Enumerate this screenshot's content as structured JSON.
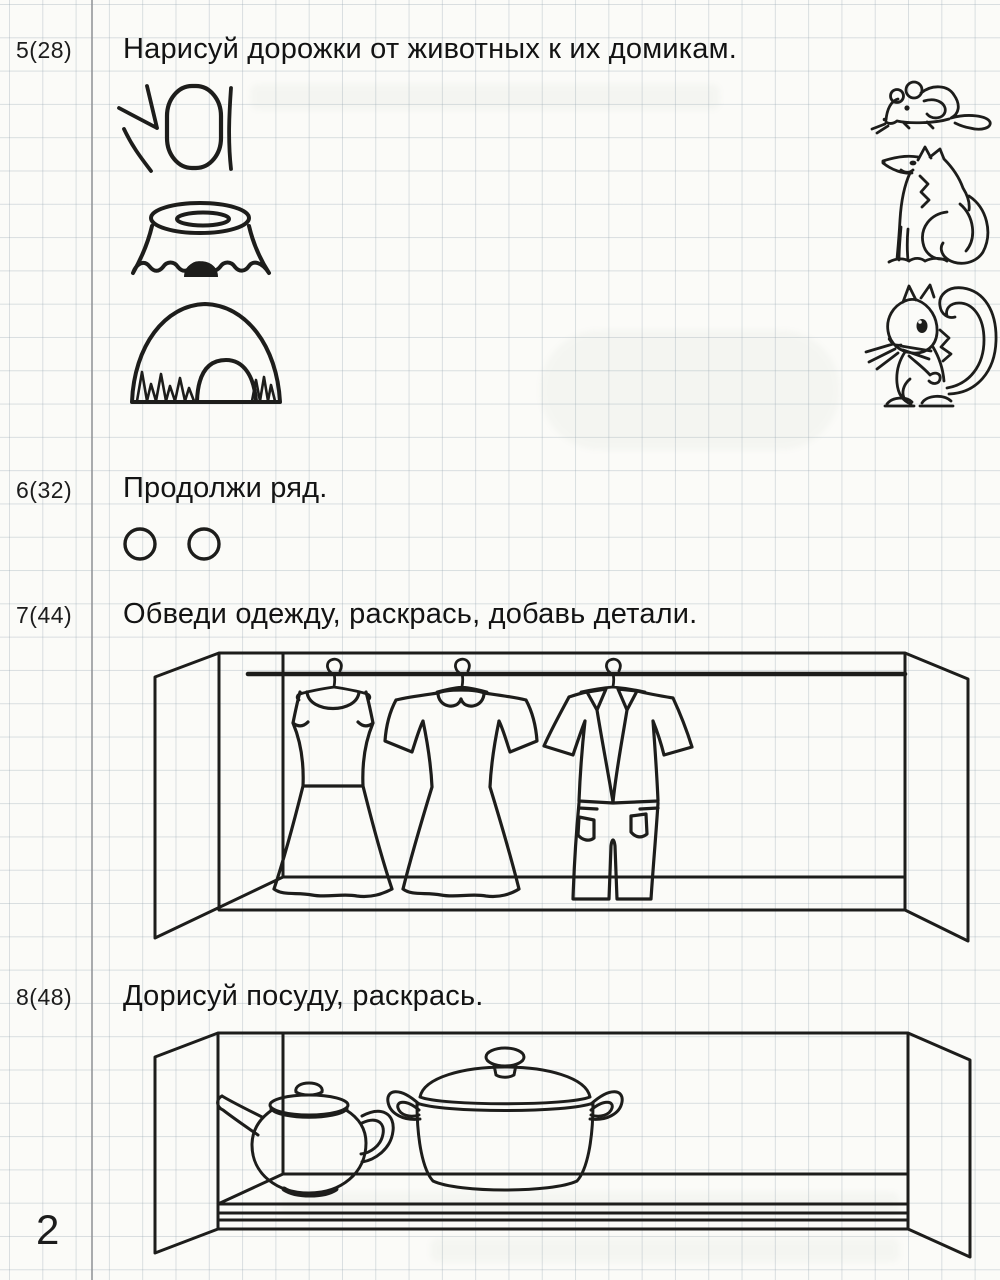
{
  "page": {
    "number": "2"
  },
  "colors": {
    "ink": "#1d1d1b",
    "paper": "#fbfbf8",
    "grid": "#c7ced3",
    "margin_line": "#8e9094"
  },
  "tasks": [
    {
      "number": "5(28)",
      "instruction": "Нарисуй дорожки от животных к их домикам."
    },
    {
      "number": "6(32)",
      "instruction": "Продолжи ряд."
    },
    {
      "number": "7(44)",
      "instruction": "Обведи одежду, раскрась, добавь детали."
    },
    {
      "number": "8(48)",
      "instruction": "Дорисуй посуду, раскрась."
    }
  ],
  "illustrations": {
    "animal_homes": [
      "tree-hollow",
      "tree-stump-with-burrow",
      "animal-den"
    ],
    "animals": [
      "mouse",
      "fox",
      "squirrel"
    ],
    "pattern_row": {
      "shape": "circle",
      "count": 2
    },
    "wardrobe_items": [
      "sundress",
      "dress-with-collar",
      "shirt-and-trousers"
    ],
    "shelf_items": [
      "teapot",
      "cooking-pot"
    ]
  }
}
